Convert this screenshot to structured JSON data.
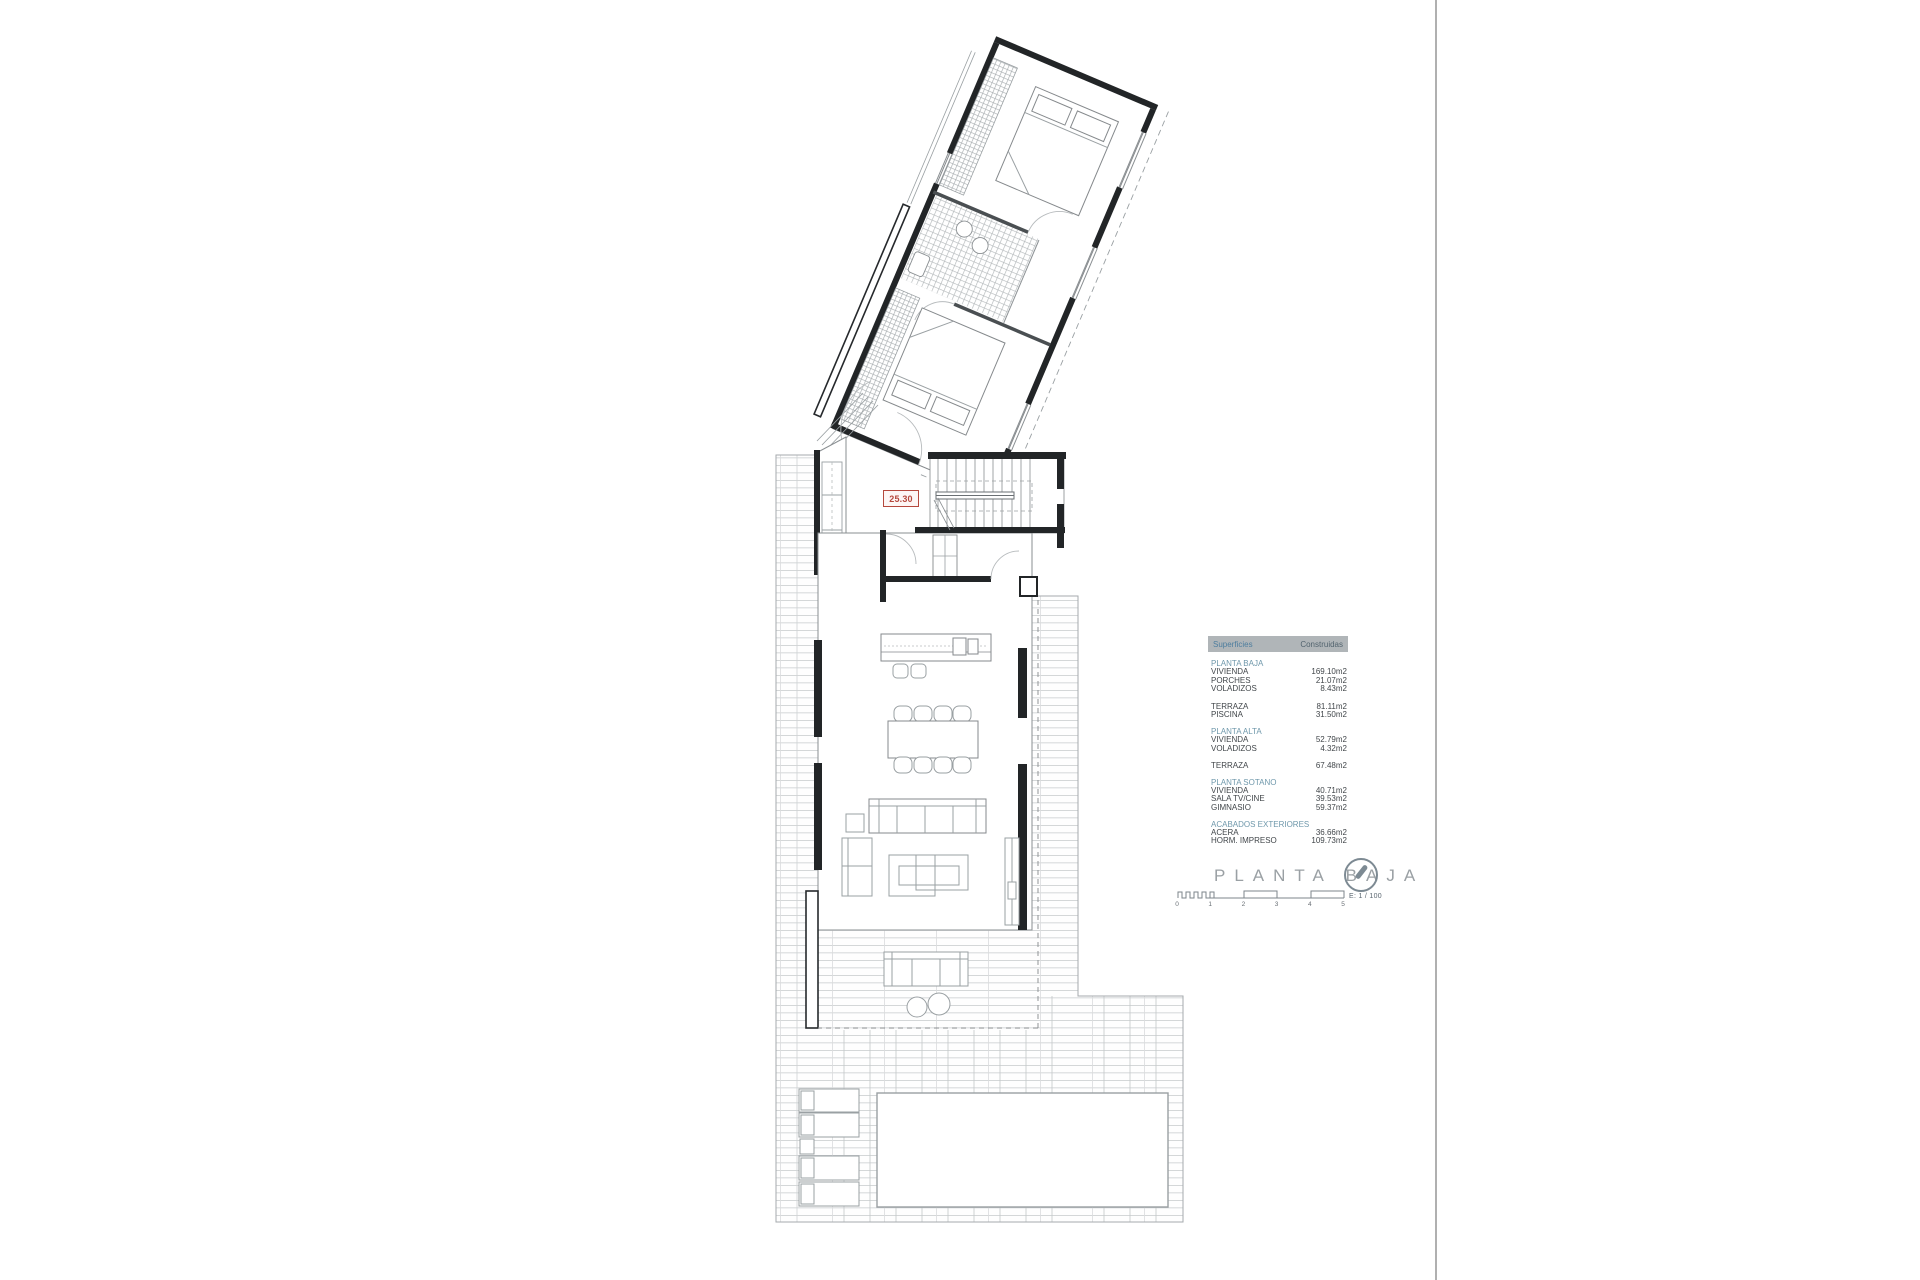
{
  "plan": {
    "dimension_label": "25.30"
  },
  "title_block": {
    "title": "PLANTA BAJA",
    "scale_label": "E: 1 / 100",
    "scale_ticks": [
      "0",
      "1",
      "2",
      "3",
      "4",
      "5"
    ],
    "compass_icon": "north-arrow"
  },
  "areas_table": {
    "col1": "Superficies",
    "col2": "Construidas",
    "sections": [
      {
        "title": "PLANTA BAJA",
        "rows": [
          {
            "label": "VIVIENDA",
            "value": "169.10m2"
          },
          {
            "label": "PORCHES",
            "value": "21.07m2"
          },
          {
            "label": "VOLADIZOS",
            "value": "8.43m2"
          }
        ]
      },
      {
        "title": "",
        "rows": [
          {
            "label": "TERRAZA",
            "value": "81.11m2"
          },
          {
            "label": "PISCINA",
            "value": "31.50m2"
          }
        ]
      },
      {
        "title": "PLANTA ALTA",
        "rows": [
          {
            "label": "VIVIENDA",
            "value": "52.79m2"
          },
          {
            "label": "VOLADIZOS",
            "value": "4.32m2"
          }
        ]
      },
      {
        "title": "",
        "rows": [
          {
            "label": "TERRAZA",
            "value": "67.48m2"
          }
        ]
      },
      {
        "title": "PLANTA SOTANO",
        "rows": [
          {
            "label": "VIVIENDA",
            "value": "40.71m2"
          },
          {
            "label": "SALA TV/CINE",
            "value": "39.53m2"
          },
          {
            "label": "GIMNASIO",
            "value": "59.37m2"
          }
        ]
      },
      {
        "title": "ACABADOS EXTERIORES",
        "rows": [
          {
            "label": "ACERA",
            "value": "36.66m2"
          },
          {
            "label": "HORM. IMPRESO",
            "value": "109.73m2"
          }
        ]
      }
    ]
  },
  "colors": {
    "accent_blue": "#4d7d9e",
    "section_blue": "#6f98ab",
    "header_bg": "#b0b5b8",
    "text_dark": "#41464a",
    "title_gray": "#9aa0a4",
    "label_red": "#b5483d",
    "divider": "#b0b0b0",
    "wall_black": "#222527",
    "line_gray": "#8a8f92",
    "tile_gray": "#c6cacc"
  }
}
